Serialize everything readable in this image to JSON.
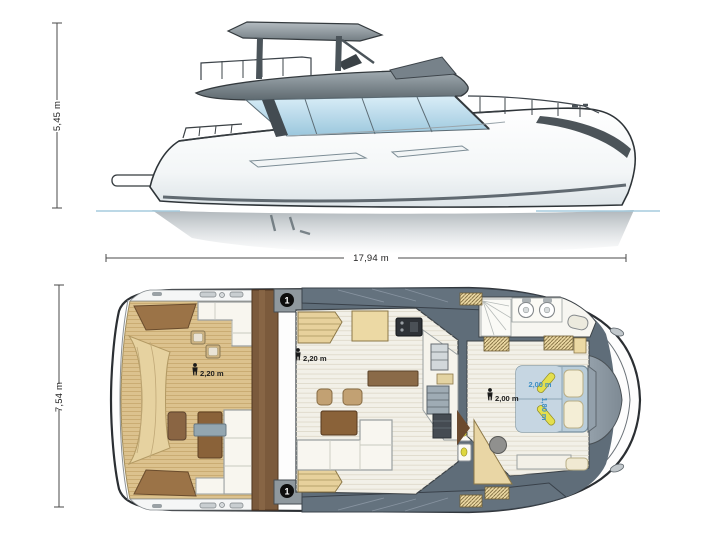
{
  "document": {
    "type": "yacht specification drawing",
    "views": [
      "side profile",
      "main deck plan"
    ]
  },
  "side_view": {
    "height_dimension": "5,45 m",
    "length_dimension": "17,94 m"
  },
  "deck_plan": {
    "beam_dimension": "7,54 m",
    "annotations": {
      "cockpit_headroom": "2,20 m",
      "saloon_headroom": "2,20 m",
      "cabin_headroom": "2,00 m",
      "bed_length": "2,00 m",
      "bed_width": "1,80 m"
    },
    "markers": [
      {
        "label": "1"
      },
      {
        "label": "1"
      }
    ]
  },
  "colors": {
    "teak_deck": "#dcc28e",
    "walkway_gray": "#64727e",
    "glass_blue": "#b9d9ea",
    "bed_blue": "#b9cdda",
    "bed_label_blue": "#3f8fc4",
    "wenge_brown": "#7b5a3c",
    "outline": "#2b2f33"
  }
}
